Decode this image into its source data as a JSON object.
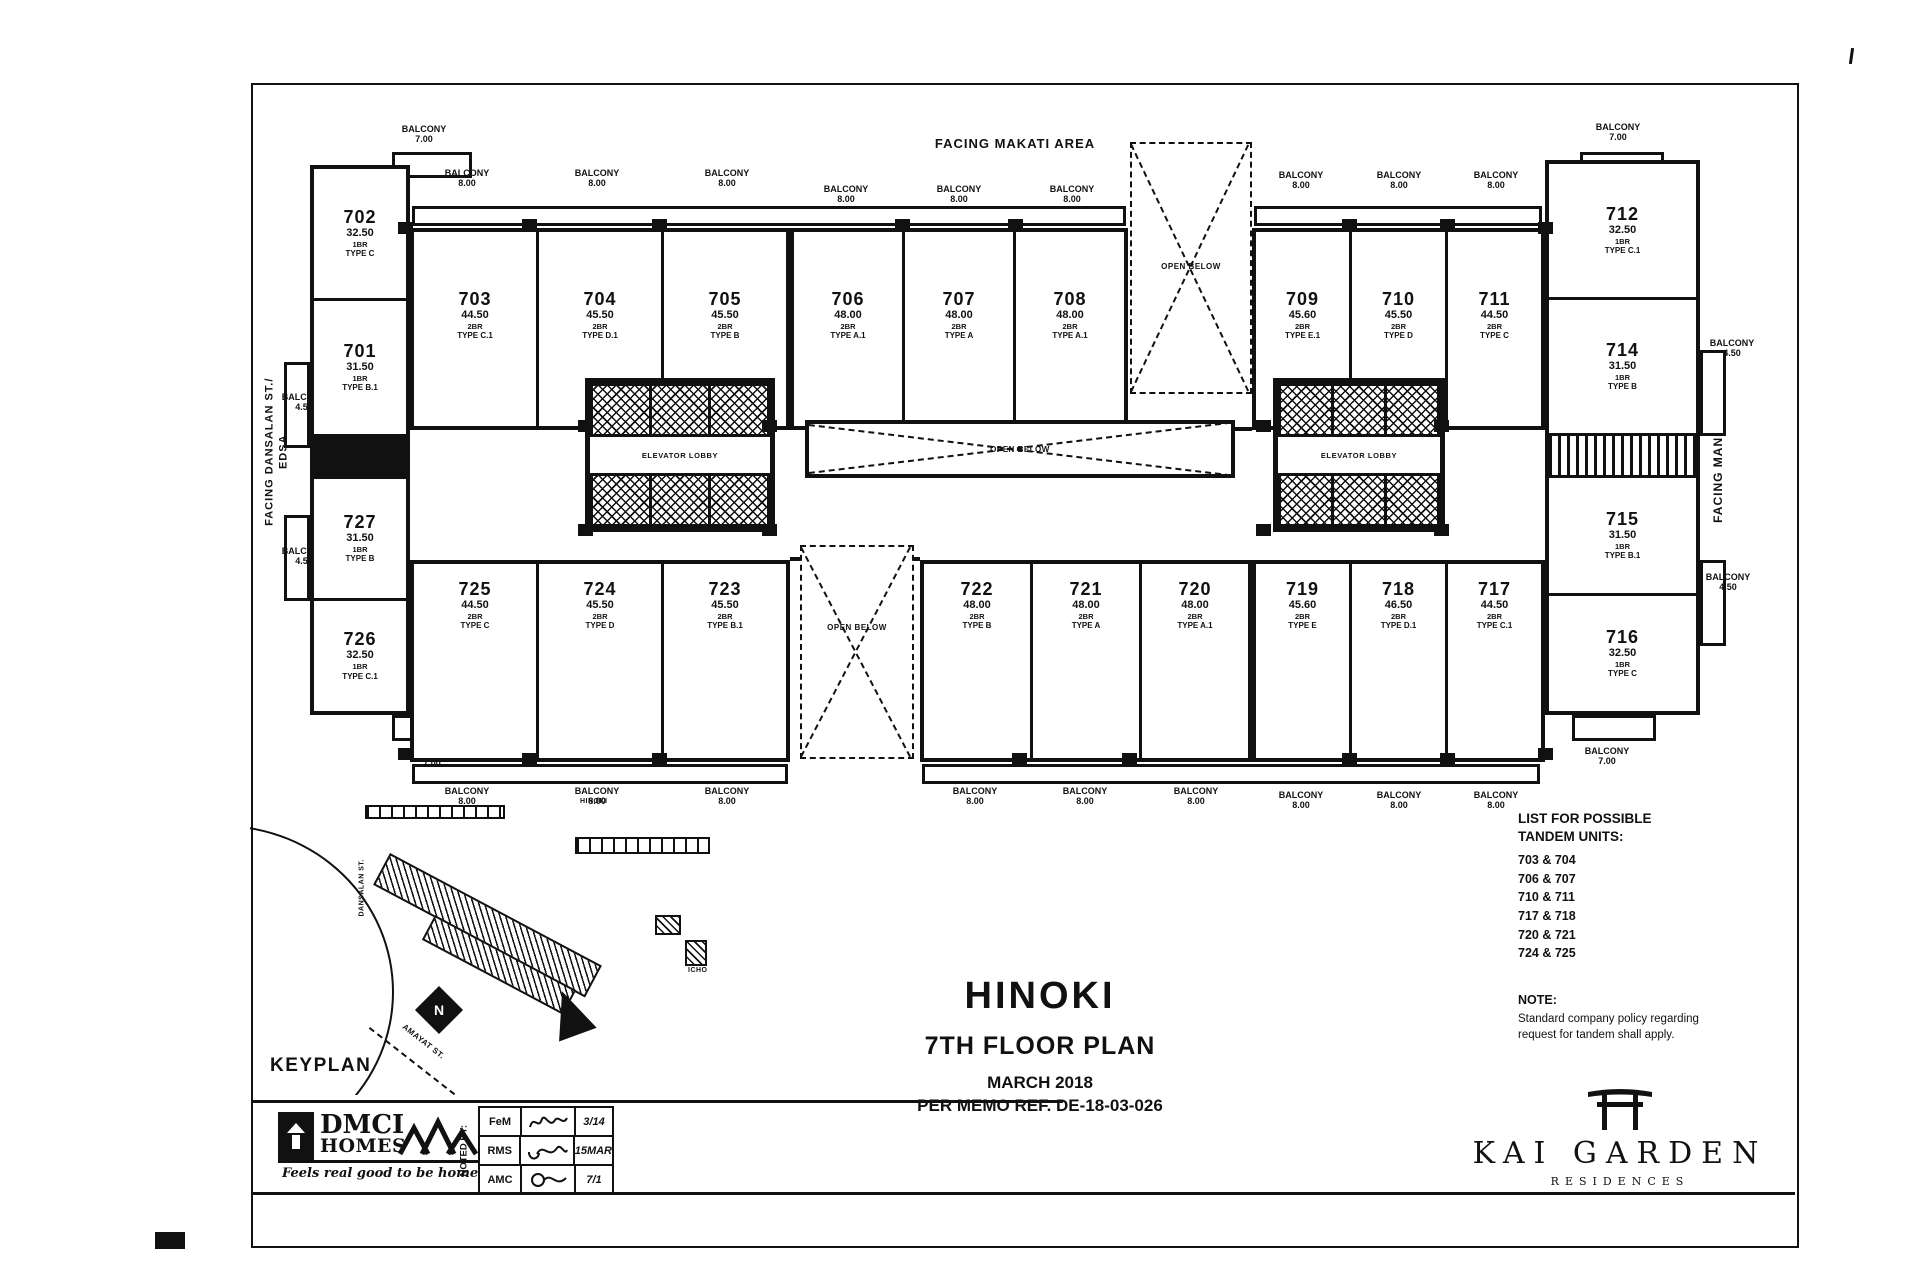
{
  "title_block": {
    "project": "HINOKI",
    "plan": "7TH FLOOR PLAN",
    "date": "MARCH 2018",
    "memo": "PER MEMO REF. DE-18-03-026"
  },
  "facing": {
    "top": "FACING MAKATI AREA",
    "bottom": "FACING AMENITIES",
    "left_line1": "FACING DANSALAN ST./",
    "left_line2": "EDSA",
    "right": "FACING MANILA AREA"
  },
  "labels": {
    "balcony": "BALCONY",
    "d800": "8.00",
    "d700": "7.00",
    "d450": "4.50",
    "elevator": "ELEVATOR LOBBY",
    "open_below": "OPEN BELOW"
  },
  "units": {
    "u701": {
      "no": "701",
      "area": "31.50",
      "br": "1BR",
      "type": "TYPE B.1"
    },
    "u702": {
      "no": "702",
      "area": "32.50",
      "br": "1BR",
      "type": "TYPE C"
    },
    "u703": {
      "no": "703",
      "area": "44.50",
      "br": "2BR",
      "type": "TYPE C.1"
    },
    "u704": {
      "no": "704",
      "area": "45.50",
      "br": "2BR",
      "type": "TYPE D.1"
    },
    "u705": {
      "no": "705",
      "area": "45.50",
      "br": "2BR",
      "type": "TYPE B"
    },
    "u706": {
      "no": "706",
      "area": "48.00",
      "br": "2BR",
      "type": "TYPE A.1"
    },
    "u707": {
      "no": "707",
      "area": "48.00",
      "br": "2BR",
      "type": "TYPE A"
    },
    "u708": {
      "no": "708",
      "area": "48.00",
      "br": "2BR",
      "type": "TYPE A.1"
    },
    "u709": {
      "no": "709",
      "area": "45.60",
      "br": "2BR",
      "type": "TYPE E.1"
    },
    "u710": {
      "no": "710",
      "area": "45.50",
      "br": "2BR",
      "type": "TYPE D"
    },
    "u711": {
      "no": "711",
      "area": "44.50",
      "br": "2BR",
      "type": "TYPE C"
    },
    "u712": {
      "no": "712",
      "area": "32.50",
      "br": "1BR",
      "type": "TYPE C.1"
    },
    "u714": {
      "no": "714",
      "area": "31.50",
      "br": "1BR",
      "type": "TYPE B"
    },
    "u715": {
      "no": "715",
      "area": "31.50",
      "br": "1BR",
      "type": "TYPE B.1"
    },
    "u716": {
      "no": "716",
      "area": "32.50",
      "br": "1BR",
      "type": "TYPE C"
    },
    "u717": {
      "no": "717",
      "area": "44.50",
      "br": "2BR",
      "type": "TYPE C.1"
    },
    "u718": {
      "no": "718",
      "area": "46.50",
      "br": "2BR",
      "type": "TYPE D.1"
    },
    "u719": {
      "no": "719",
      "area": "45.60",
      "br": "2BR",
      "type": "TYPE E"
    },
    "u720": {
      "no": "720",
      "area": "48.00",
      "br": "2BR",
      "type": "TYPE A.1"
    },
    "u721": {
      "no": "721",
      "area": "48.00",
      "br": "2BR",
      "type": "TYPE A"
    },
    "u722": {
      "no": "722",
      "area": "48.00",
      "br": "2BR",
      "type": "TYPE B"
    },
    "u723": {
      "no": "723",
      "area": "45.50",
      "br": "2BR",
      "type": "TYPE B.1"
    },
    "u724": {
      "no": "724",
      "area": "45.50",
      "br": "2BR",
      "type": "TYPE D"
    },
    "u725": {
      "no": "725",
      "area": "44.50",
      "br": "2BR",
      "type": "TYPE C"
    },
    "u726": {
      "no": "726",
      "area": "32.50",
      "br": "1BR",
      "type": "TYPE C.1"
    },
    "u727": {
      "no": "727",
      "area": "31.50",
      "br": "1BR",
      "type": "TYPE B"
    }
  },
  "tandem": {
    "heading1": "LIST FOR POSSIBLE",
    "heading2": "TANDEM UNITS:",
    "pairs": [
      "703 & 704",
      "706 & 707",
      "710 & 711",
      "717 & 718",
      "720 & 721",
      "724 & 725"
    ],
    "note_label": "NOTE:",
    "note_line1": "Standard company policy regarding",
    "note_line2": "request for tandem shall apply."
  },
  "keyplan": {
    "title": "KEYPLAN",
    "bldg_hinoki": "HINOKI",
    "bldg_icho": "ICHO",
    "street_vertical": "DANSALAN ST.",
    "street_diagonal": "AMAYAT ST.",
    "north": "N"
  },
  "footer": {
    "noted_by": "NOTED BY:",
    "rows": [
      {
        "initials": "FeM",
        "date": "3/14"
      },
      {
        "initials": "RMS",
        "date": "15MAR"
      },
      {
        "initials": "AMC",
        "date": "7/1"
      }
    ]
  },
  "dmci": {
    "name_line1": "DMCI",
    "name_line2": "HOMES",
    "tagline": "Feels real good to be home"
  },
  "brand": {
    "name": "KAI GARDEN",
    "sub": "RESIDENCES"
  }
}
